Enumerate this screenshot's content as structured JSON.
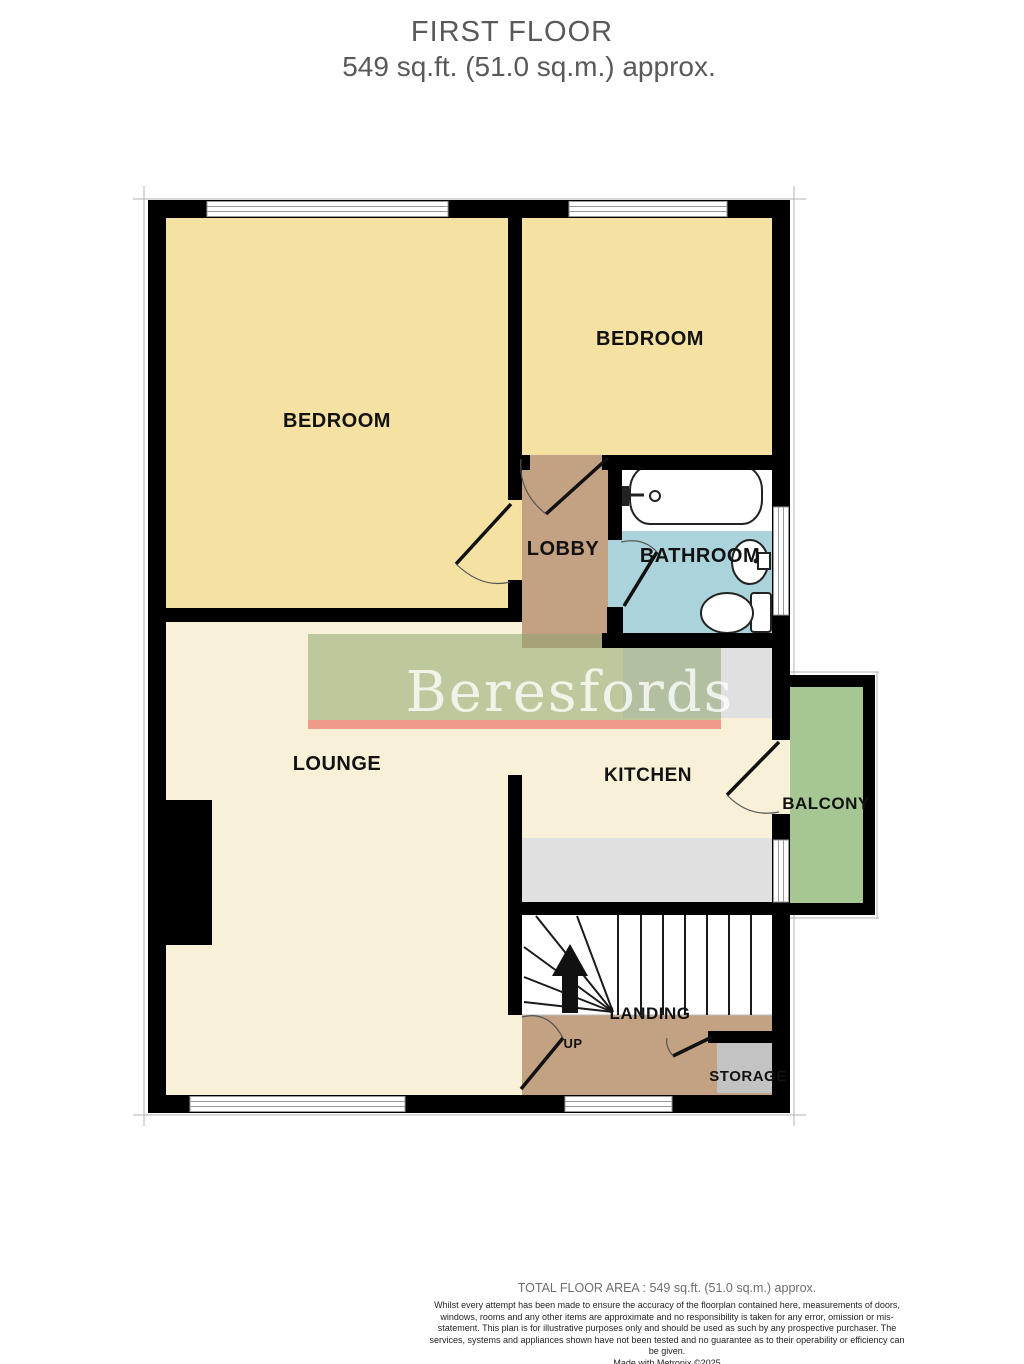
{
  "header": {
    "floor": "FIRST FLOOR",
    "area": "549 sq.ft. (51.0 sq.m.) approx."
  },
  "watermark": {
    "brand": "Beresfords"
  },
  "rooms": {
    "bedroom_left": {
      "label": "BEDROOM"
    },
    "bedroom_right": {
      "label": "BEDROOM"
    },
    "lobby": {
      "label": "LOBBY"
    },
    "bathroom": {
      "label": "BATHROOM"
    },
    "lounge": {
      "label": "LOUNGE"
    },
    "kitchen": {
      "label": "KITCHEN"
    },
    "balcony": {
      "label": "BALCONY"
    },
    "landing": {
      "label": "LANDING"
    },
    "storage": {
      "label": "STORAGE"
    },
    "stairs": {
      "direction_label": "UP"
    }
  },
  "colors": {
    "wall": "#000000",
    "bedroom_floor": "#F5E2A2",
    "living_floor": "#F8F1D8",
    "hall_floor": "#C3A183",
    "bathroom_floor": "#ABD3DC",
    "balcony_floor": "#A6C693",
    "counter_gray": "#E0E0E0",
    "storage_gray": "#C3C3C3",
    "stairs_white": "#FFFFFF",
    "watermark_green": "rgba(140,165,110,0.55)",
    "watermark_red": "rgba(235,100,90,0.62)",
    "title_gray": "#595959"
  },
  "footer": {
    "total_area": "TOTAL FLOOR AREA : 549 sq.ft. (51.0 sq.m.) approx.",
    "disclaimer": "Whilst every attempt has been made to ensure the accuracy of the floorplan contained here, measurements of doors, windows, rooms and any other items are approximate and no responsibility is taken for any error, omission or mis-statement. This plan is for illustrative purposes only and should be used as such by any prospective purchaser. The services, systems and appliances shown have not been tested and no guarantee as to their operability or efficiency can be given.",
    "credit": "Made with Metropix ©2025"
  }
}
